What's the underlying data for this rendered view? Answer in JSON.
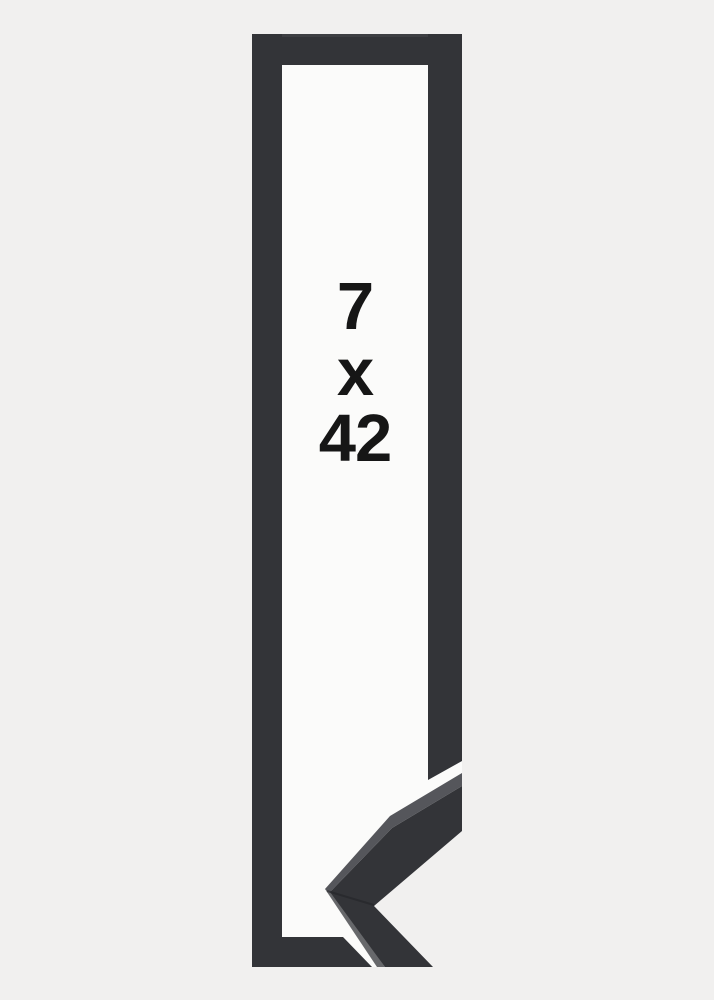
{
  "size_label": {
    "width": "7",
    "separator": "x",
    "height": "42"
  },
  "colors": {
    "bg": "#f1f0ef",
    "paper": "#fbfbfa",
    "frame": "#333438",
    "frame-top-edge": "#3e3f43",
    "frame-top-face": "#55565b",
    "edge-highlight": "#67686b",
    "seam": "#232428",
    "label-text": "#161616"
  }
}
